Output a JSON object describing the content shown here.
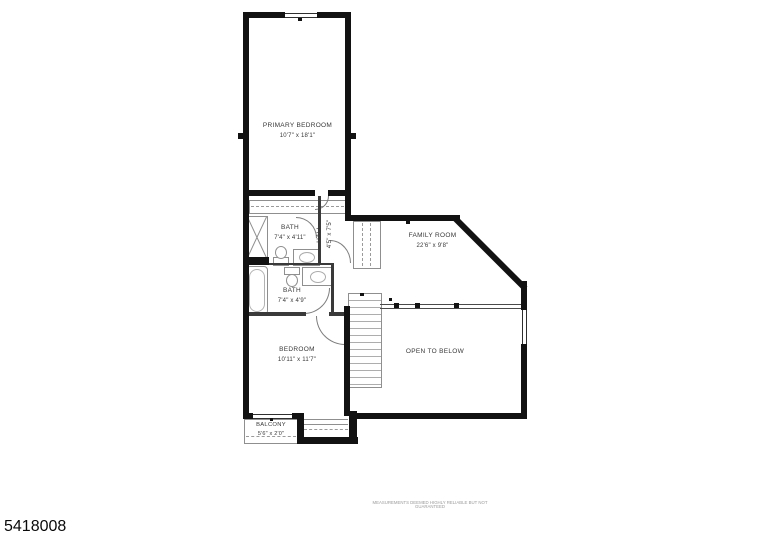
{
  "rooms": {
    "primary_bedroom": {
      "label": "PRIMARY BEDROOM",
      "dims": "10'7\" x 18'1\""
    },
    "bath_upper": {
      "label": "BATH",
      "dims": "7'4\" x 4'11\""
    },
    "hall": {
      "label": "HALL",
      "dims": "4'5\" x 7'5\""
    },
    "family_room": {
      "label": "FAMILY ROOM",
      "dims": "22'6\" x 9'8\""
    },
    "bath_lower": {
      "label": "BATH",
      "dims": "7'4\" x 4'9\""
    },
    "bedroom": {
      "label": "BEDROOM",
      "dims": "10'11\" x 11'7\""
    },
    "open_to_below": {
      "label": "OPEN TO BELOW"
    },
    "balcony": {
      "label": "BALCONY",
      "dims": "5'6\" x 2'0\""
    }
  },
  "footer": {
    "listing_id": "5418008",
    "disclaimer": "MEASUREMENTS DEEMED HIGHLY RELIABLE BUT NOT GUARANTEED"
  },
  "colors": {
    "wall": "#121212",
    "fixture": "#8f8f8f",
    "background": "#ffffff"
  }
}
